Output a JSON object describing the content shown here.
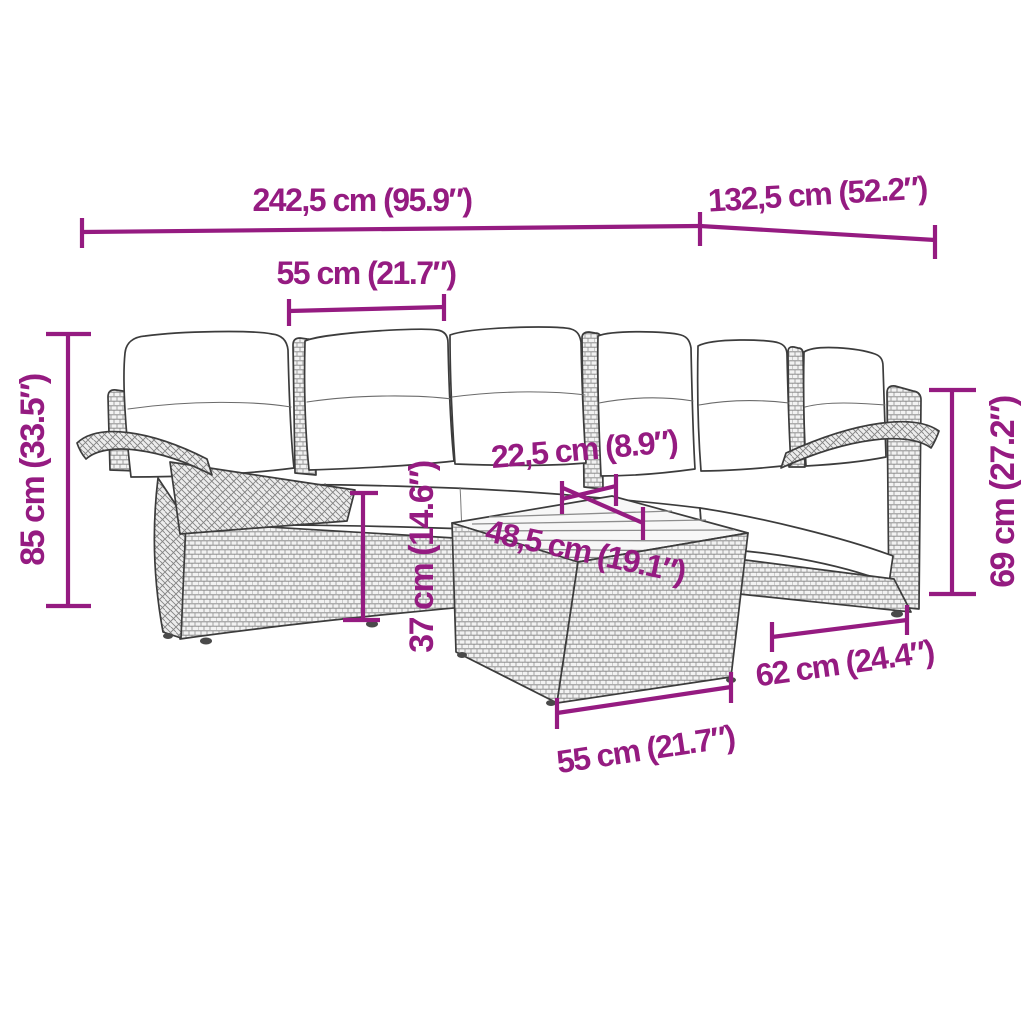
{
  "diagram": {
    "type": "product-dimension-diagram",
    "subject": "L-shaped poly rattan garden lounge set with cushions and coffee table",
    "background_color": "#ffffff",
    "dimension_color": "#951B81",
    "linework_color": "#3C3C3C"
  },
  "dimensions": {
    "overall_length": {
      "label": "242,5 cm (95.9″)",
      "cm": "242,5",
      "inches": "95.9"
    },
    "side_depth": {
      "label": "132,5 cm (52.2″)",
      "cm": "132,5",
      "inches": "52.2"
    },
    "seat_width": {
      "label": "55 cm (21.7″)",
      "cm": "55",
      "inches": "21.7"
    },
    "overall_height": {
      "label": "85 cm (33.5″)",
      "cm": "85",
      "inches": "33.5"
    },
    "armrest_height": {
      "label": "69 cm (27.2″)",
      "cm": "69",
      "inches": "27.2"
    },
    "sofa_table_gap": {
      "label": "22,5 cm (8.9″)",
      "cm": "22,5",
      "inches": "8.9"
    },
    "tabletop_depth": {
      "label": "48,5 cm (19.1″)",
      "cm": "48,5",
      "inches": "19.1"
    },
    "table_height": {
      "label": "37 cm (14.6″)",
      "cm": "37",
      "inches": "14.6"
    },
    "armchair_depth": {
      "label": "62 cm (24.4″)",
      "cm": "62",
      "inches": "24.4"
    },
    "table_width": {
      "label": "55 cm (21.7″)",
      "cm": "55",
      "inches": "21.7"
    }
  }
}
